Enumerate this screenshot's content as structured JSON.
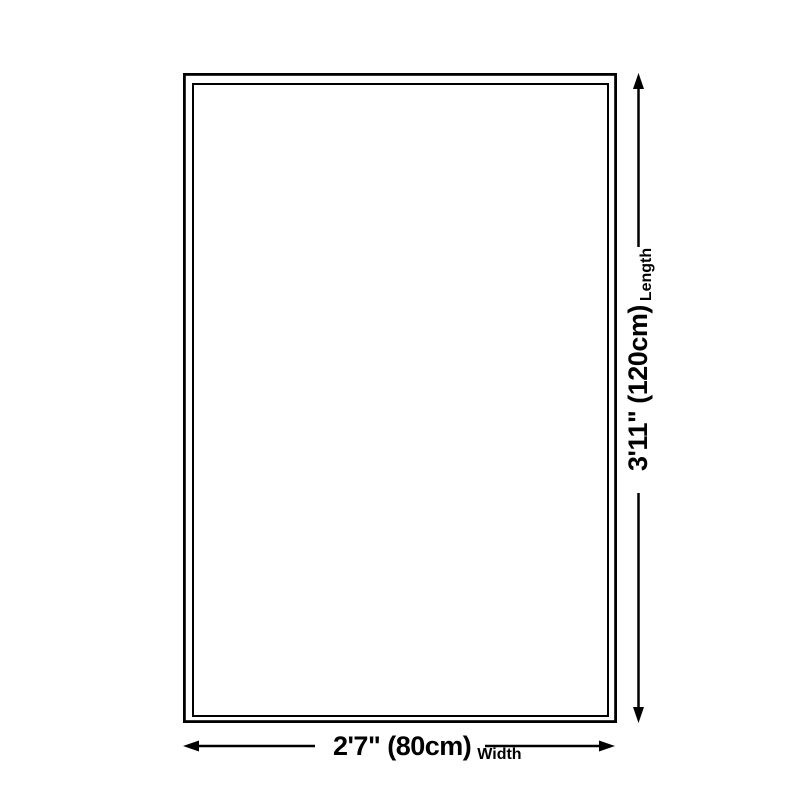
{
  "diagram": {
    "type": "product-size-diagram",
    "shape": "rectangle",
    "dimensions": {
      "length": {
        "value": "3'11\" (120cm)",
        "axis_label": "Length",
        "orientation": "vertical"
      },
      "width": {
        "value": "2'7\" (80cm)",
        "axis_label": "Width",
        "orientation": "horizontal"
      }
    },
    "colors": {
      "line": "#000000",
      "background": "#ffffff"
    }
  }
}
